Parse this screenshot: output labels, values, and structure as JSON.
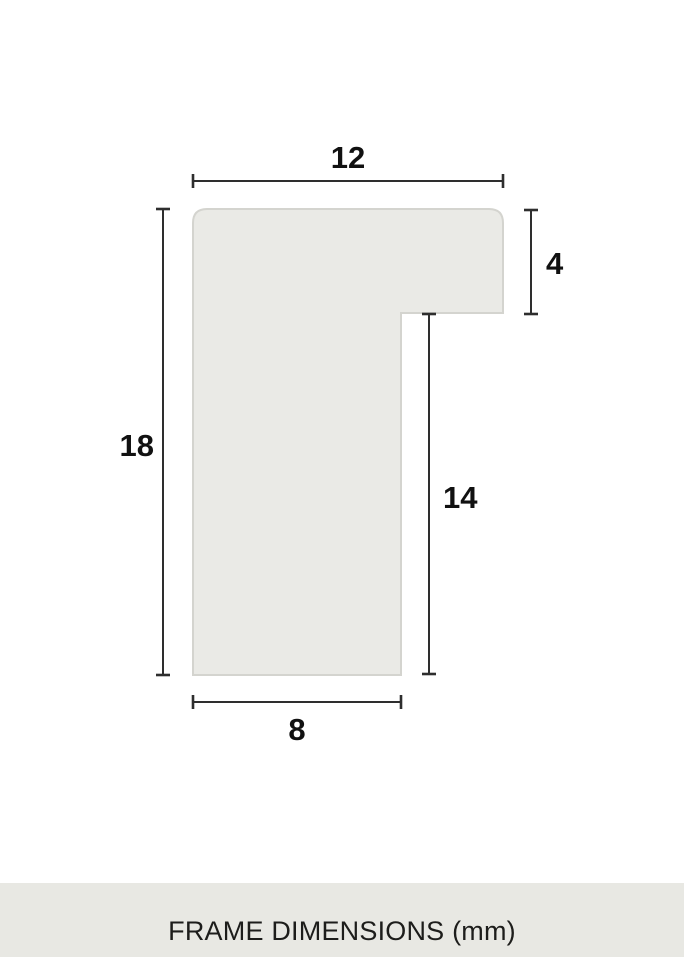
{
  "diagram": {
    "dimensions": {
      "top_width": "12",
      "left_height": "18",
      "right_flange_height": "4",
      "inner_right_height": "14",
      "bottom_width": "8"
    }
  },
  "footer": {
    "caption": "FRAME DIMENSIONS (mm)"
  },
  "colors": {
    "background": "#ffffff",
    "shape_fill": "#eaeae6",
    "shape_stroke": "#d4d4cf",
    "dimension_line": "#2e2e2e",
    "label_text": "#111111",
    "footer_background": "#e8e8e3",
    "footer_text": "#1d1d1b"
  }
}
